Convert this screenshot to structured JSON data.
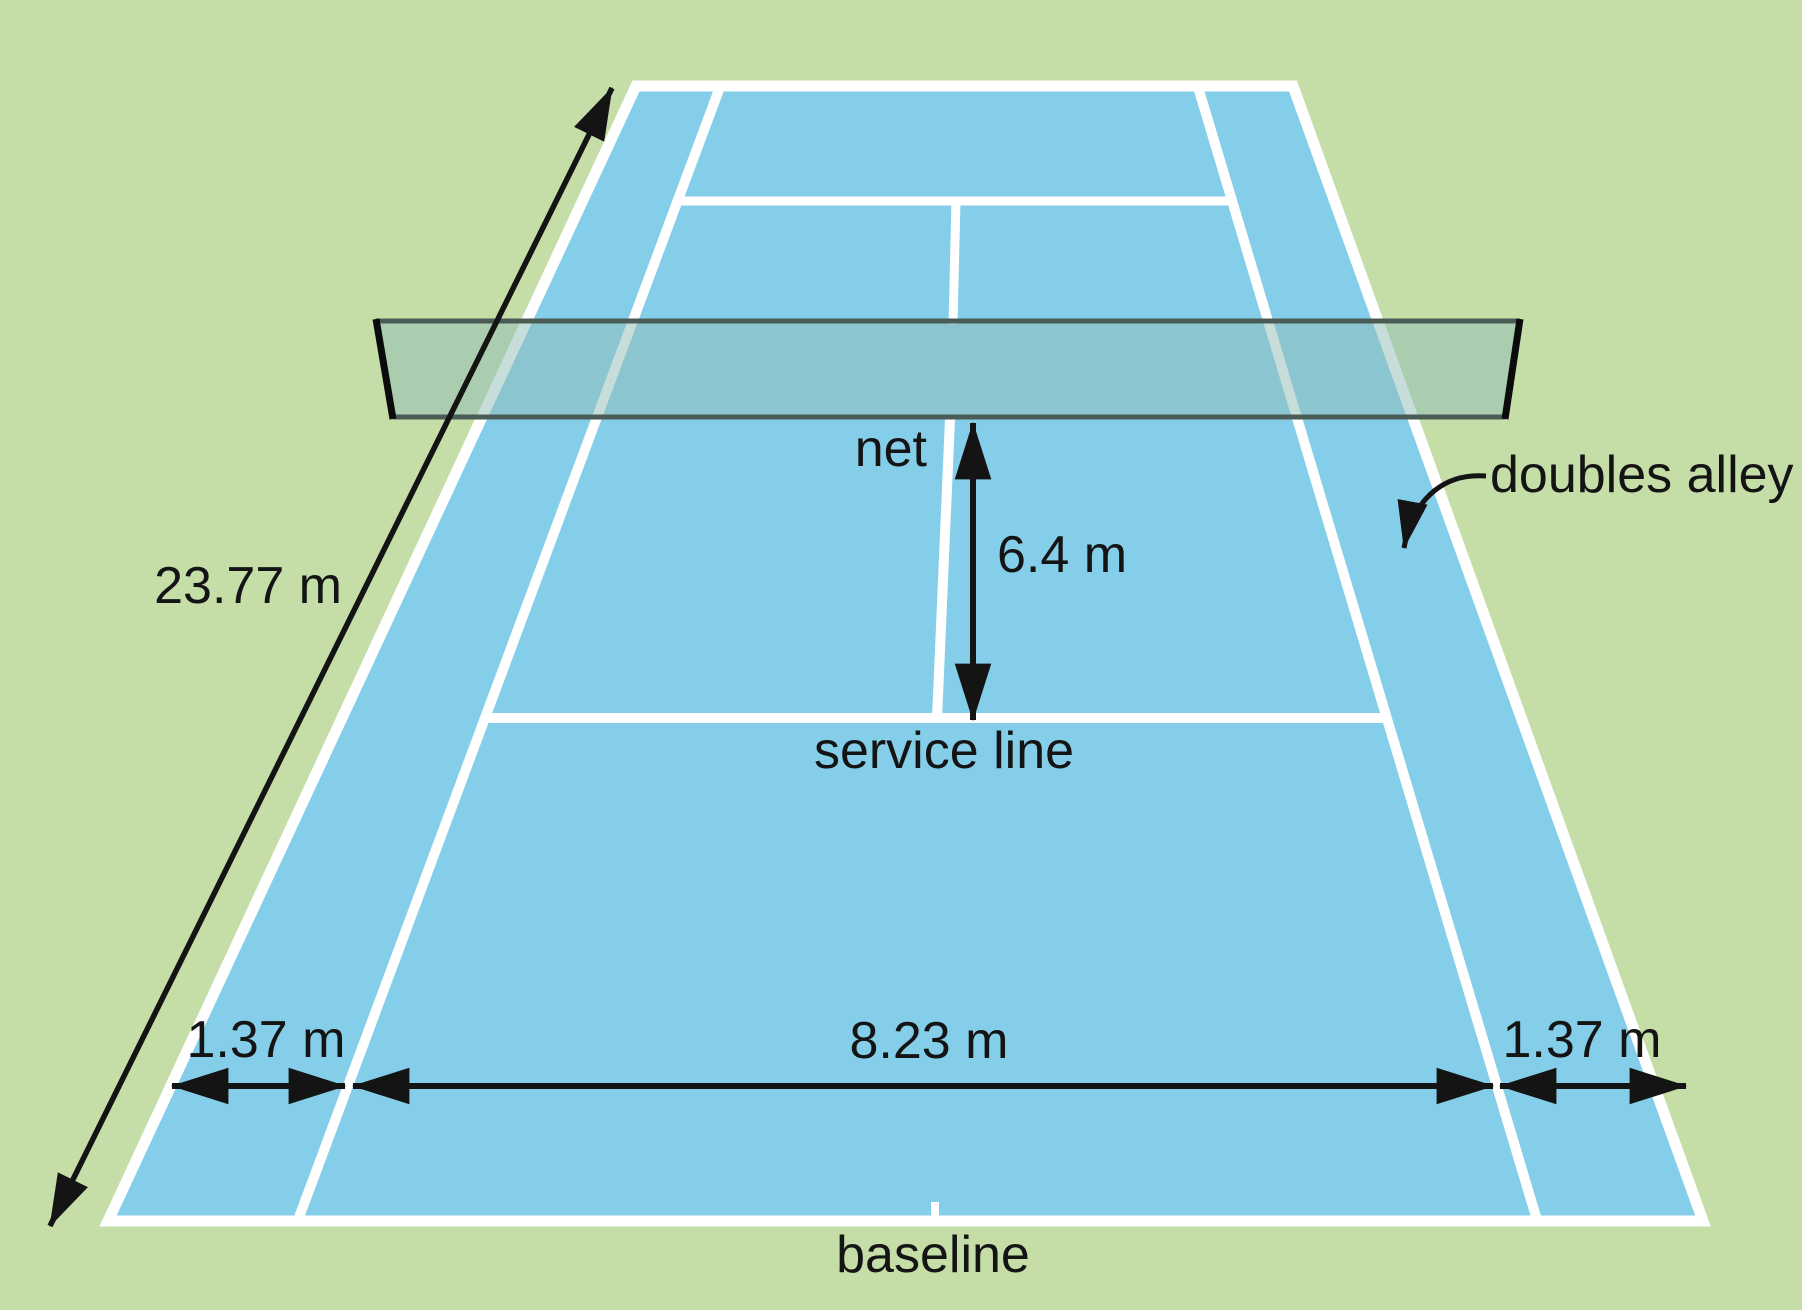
{
  "figure": {
    "type": "diagram",
    "subject": "tennis court dimensions",
    "background_color": "#c5dda7",
    "text_color": "#141414",
    "arrow_color": "#141414",
    "court": {
      "surface_color": "#85cee9",
      "line_color": "#ffffff"
    },
    "net": {
      "fill": "rgba(145,190,185,0.52)",
      "band_border_color": "#4b5b56",
      "side_edge_color": "#0b0b0b"
    },
    "labels": {
      "net": "net",
      "service_line": "service line",
      "baseline": "baseline",
      "doubles_alley": "doubles alley"
    },
    "dimensions": {
      "court_length": "23.77 m",
      "net_to_service_line": "6.4 m",
      "singles_width": "8.23 m",
      "alley_width_left": "1.37 m",
      "alley_width_right": "1.37 m"
    }
  }
}
